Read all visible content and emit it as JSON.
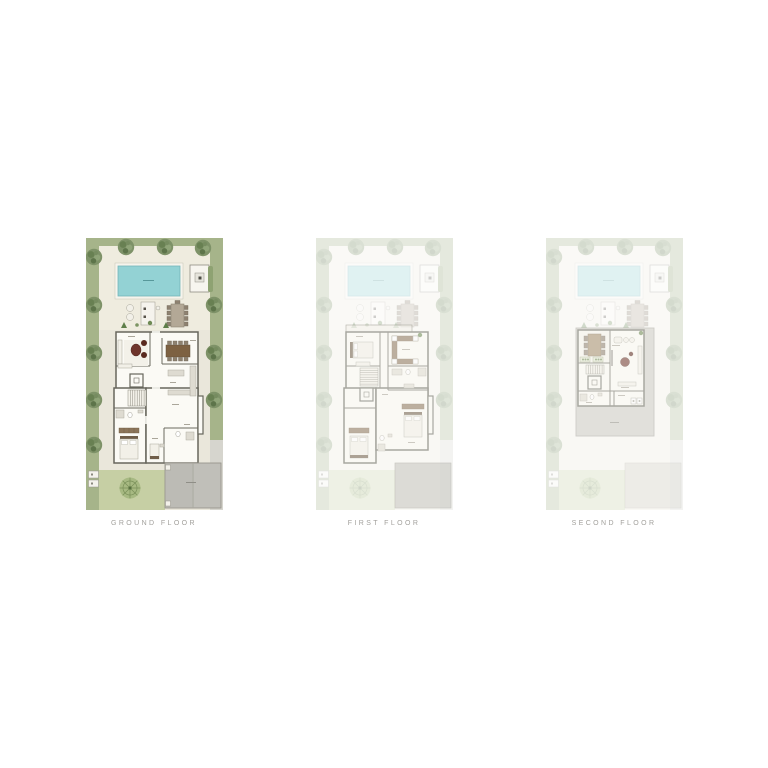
{
  "page": {
    "background": "#ffffff"
  },
  "floors": [
    {
      "id": "ground-floor",
      "label": "GROUND FLOOR",
      "state": "active"
    },
    {
      "id": "first-floor",
      "label": "FIRST FLOOR",
      "state": "faded"
    },
    {
      "id": "second-floor",
      "label": "SECOND FLOOR",
      "state": "faded"
    }
  ],
  "palette": {
    "lawn": "#a6b48a",
    "lot": "#eae7db",
    "pool_deck": "#efecdf",
    "pool_water": "#93d2d4",
    "tree": "#7e9268",
    "wall": "#67665c",
    "room": "#fbfaf5",
    "wood_dark": "#7d6142",
    "wood": "#8c755a",
    "accent_red": "#6e342b",
    "garage_roof": "#c0bfb9",
    "driveway": "#d6d5ce",
    "courtyard": "#c6cfa4",
    "label_text": "#a2a09c"
  }
}
